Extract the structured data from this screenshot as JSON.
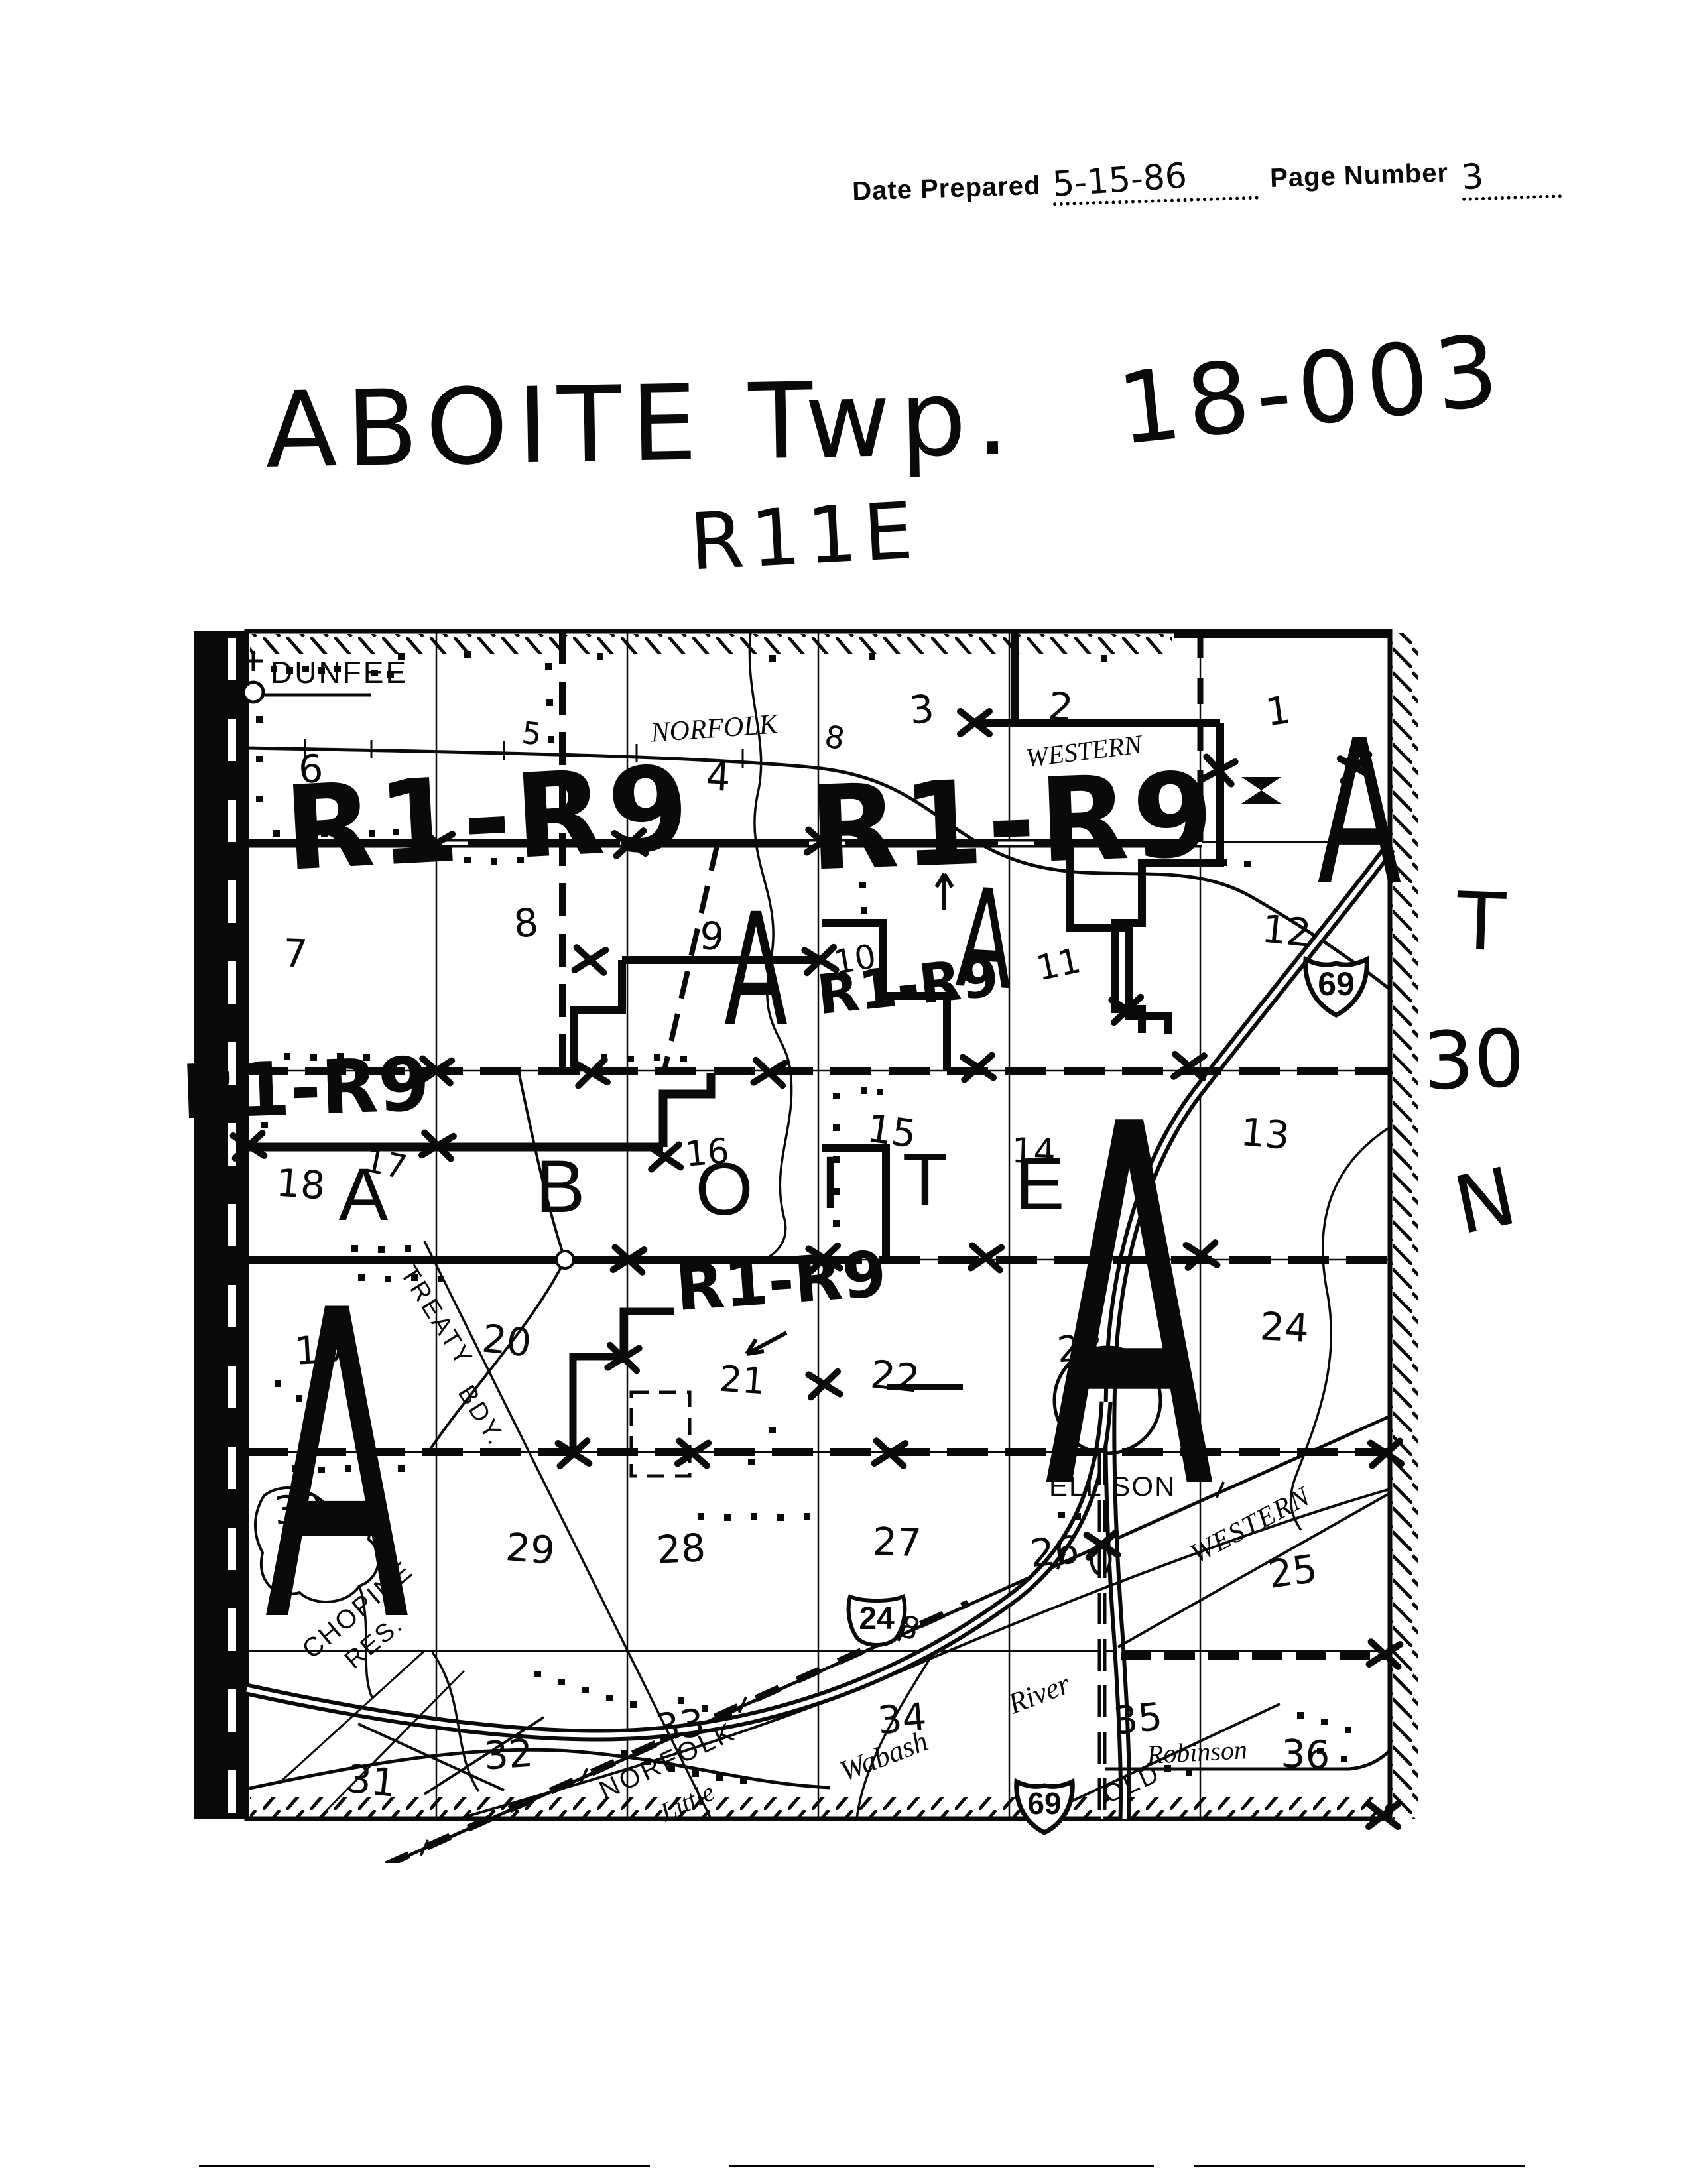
{
  "header": {
    "date_prepared_label": "Date Prepared",
    "date_value": "5-15-86",
    "page_number_label": "Page Number",
    "page_value": "3"
  },
  "title": {
    "township_name": "ABOITE Twp.",
    "code": "18-003",
    "range": "R11E"
  },
  "township_range_marker": {
    "t": "T",
    "num": "30",
    "n": "N"
  },
  "map": {
    "section_numbers": [
      "6",
      "5",
      "4",
      "3",
      "2",
      "1",
      "7",
      "8",
      "9",
      "10",
      "11",
      "12",
      "18",
      "17",
      "16",
      "15",
      "14",
      "13",
      "19",
      "20",
      "21",
      "22",
      "23",
      "24",
      "30",
      "29",
      "28",
      "27",
      "26",
      "25",
      "31",
      "32",
      "33",
      "34",
      "35",
      "36"
    ],
    "zoning": {
      "r1r9_a": "R1-R9",
      "r1r9_b": "R1-R9",
      "r1r9_c": "R1-R9",
      "r1r9_d": "R1-R9",
      "r1r9_e": "R1-R9"
    },
    "big_letters": {
      "a1": "A",
      "a2": "A",
      "a3": "A",
      "giant_a1": "A",
      "giant_a2": "A"
    },
    "township_letters": [
      "A",
      "B",
      "O",
      "I",
      "T",
      "E"
    ],
    "places": {
      "dunfee": "DUNFEE",
      "norfolk_top": "NORFOLK",
      "western_top": "WESTERN",
      "ellison": "ELLISON",
      "treaty": "TREATY",
      "bdy": "BDY.",
      "chopine": "CHOPINE",
      "res": "RES.",
      "wabash": "Wabash",
      "river": "River",
      "robinson": "Robinson",
      "old": "OLD",
      "western_low": "WESTERN",
      "norfolk_low": "NORFOLK",
      "little": "Little"
    },
    "road_numbers": {
      "route8_top": "8",
      "route8_mid": "8"
    },
    "shields": {
      "i69": "69",
      "i69_bottom": "69",
      "us24": "24"
    }
  }
}
